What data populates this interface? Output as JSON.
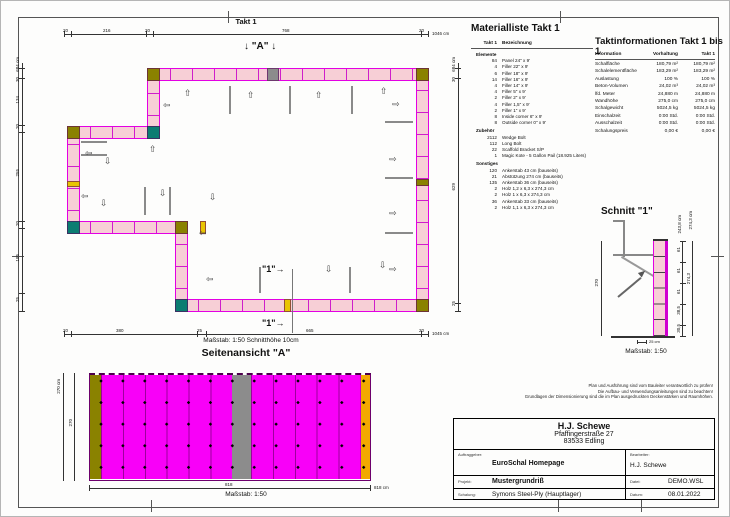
{
  "sheet": {
    "plan_title": "Takt 1",
    "plan_scale_note": "Maßstab: 1:50   Schnitthöhe 10cm",
    "view_arrow_label": "\"A\"",
    "section_marker_label": "\"1\""
  },
  "icons": {
    "arrow_up": "⇧",
    "arrow_down": "⇩",
    "arrow_left": "⇦",
    "arrow_right": "⇨",
    "down_arrow": "↓",
    "right_arrow": "→"
  },
  "plan_dims": {
    "top": [
      "20",
      "216",
      "20",
      "768",
      "20"
    ],
    "top_total": "1046 cm",
    "bottom": [
      "20",
      "380",
      "25",
      "665",
      "20"
    ],
    "bottom_total": "1045 cm",
    "left": [
      "30",
      "134",
      "20",
      "255",
      "20",
      "185",
      "25"
    ],
    "left_total": "684 cm",
    "right": [
      "30",
      "629",
      "25"
    ],
    "right_total": "684 cm"
  },
  "side_view": {
    "title": "Seitenansicht \"A\"",
    "height_total": "270 cm",
    "height_chain": "270",
    "width_mid": "818",
    "width_total": "818 cm",
    "scale": "Maßstab: 1:50"
  },
  "section_view": {
    "title": "Schnitt \"1\"",
    "scale": "Maßstab: 1:50",
    "scale_bar": "25 cm",
    "dim_height_left": "270",
    "dim_segments": [
      "61",
      "61",
      "61",
      "38,5",
      "30,5"
    ],
    "dim_total": "274,3",
    "dim_top_inner": "243,8 cm",
    "dim_top_outer": "274,3 cm"
  },
  "material_list": {
    "title": "Materialliste  Takt 1",
    "col_qty": "Takt 1",
    "col_name": "Bezeichnung",
    "rows": [
      {
        "qty": "",
        "name": "Elemente",
        "bold": true
      },
      {
        "qty": "84",
        "name": "Panel 24\" x 9'"
      },
      {
        "qty": "4",
        "name": "Filler 22\" x 9'"
      },
      {
        "qty": "6",
        "name": "Filler 18\" x 9'"
      },
      {
        "qty": "14",
        "name": "Filler 16\" x 9'"
      },
      {
        "qty": "4",
        "name": "Filler 14\" x 9'"
      },
      {
        "qty": "4",
        "name": "Filler 5\" x 9'"
      },
      {
        "qty": "2",
        "name": "Filler 2\" x 9'"
      },
      {
        "qty": "4",
        "name": "Filler 1,5\" x 9'"
      },
      {
        "qty": "2",
        "name": "Filler 1\" x 9'"
      },
      {
        "qty": "8",
        "name": "Inside corner 6\" x 9'"
      },
      {
        "qty": "8",
        "name": "Outside corner 0\" x 9'"
      },
      {
        "qty": "",
        "name": "Zubehör",
        "bold": true
      },
      {
        "qty": "2112",
        "name": "Wedge Bolt"
      },
      {
        "qty": "112",
        "name": "Long Bolt"
      },
      {
        "qty": "22",
        "name": "Scaffold Bracket S/P"
      },
      {
        "qty": "1",
        "name": "Magic Kote - 5 Gallon Pail (18.925 Liters)"
      },
      {
        "qty": "",
        "name": "Sonstiges",
        "bold": true
      },
      {
        "qty": "120",
        "name": "Ankerstab 43 cm (bauseits)"
      },
      {
        "qty": "21",
        "name": "Abstützung 274 cm (bauseits)"
      },
      {
        "qty": "135",
        "name": "Ankerstab 36 cm (bauseits)"
      },
      {
        "qty": "2",
        "name": "Holz 1,2 x 6,3 x 274,3 cm"
      },
      {
        "qty": "2",
        "name": "Holz 1 x 6,3 x 274,3 cm"
      },
      {
        "qty": "36",
        "name": "Ankerstab 33 cm (bauseits)"
      },
      {
        "qty": "2",
        "name": "Holz 1,1 x 6,3 x 274,3 cm"
      }
    ]
  },
  "takt_info": {
    "title": "Taktinformationen  Takt 1 bis 1",
    "col_info": "Information",
    "col_vorhaltung": "Vorhaltung",
    "col_takt": "Takt 1",
    "rows": [
      {
        "label": "Schalfläche",
        "vorhaltung": "180,79 m²",
        "takt": "180,79 m²"
      },
      {
        "label": "Schalelementfläche",
        "vorhaltung": "183,29 m²",
        "takt": "183,29 m²"
      },
      {
        "label": "Auslastung",
        "vorhaltung": "100 %",
        "takt": "100 %"
      },
      {
        "label": "Beton-Volumen",
        "vorhaltung": "24,02 m³",
        "takt": "24,02 m³"
      },
      {
        "label": "lfd. Meter",
        "vorhaltung": "24,880 m",
        "takt": "24,880 m"
      },
      {
        "label": "Wandhöhe",
        "vorhaltung": "275,0 cm",
        "takt": "275,0 cm"
      },
      {
        "label": "Schalgewicht",
        "vorhaltung": "5024,5 kg",
        "takt": "5024,5 kg"
      },
      {
        "label": "Einschalzeit",
        "vorhaltung": "0:00 Std.",
        "takt": "0:00 Std."
      },
      {
        "label": "Ausschalzeit",
        "vorhaltung": "0:00 Std.",
        "takt": "0:00 Std."
      },
      {
        "label": "Schalungspreis",
        "vorhaltung": "0,00 €",
        "takt": "0,00 €"
      }
    ]
  },
  "disclaimer": {
    "line1": "Plan und Ausführung sind vom Bauleiter verantwortlich zu prüfen!",
    "line2": "Die Aufbau- und Verwendungsanleitungen sind zu beachten!",
    "line3": "Grundlagen der Dimensionierung sind die im Plan ausgedruckten Deckenstärken und Raumhöhen."
  },
  "title_block": {
    "company": "H.J. Schewe",
    "street": "Pfaffingerstraße 27",
    "city": "83533 Edling",
    "label_auftraggeber": "Auftraggeber:",
    "auftraggeber": "EuroSchal Homepage",
    "label_bearbeiter": "Bearbeiter:",
    "bearbeiter": "H.J. Schewe",
    "label_projekt": "Projekt:",
    "projekt": "Mustergrundriß",
    "label_datei": "Datei:",
    "datei": "DEMO.WSL",
    "label_schalung": "Schalung:",
    "schalung": "Symons Steel-Ply (Hauptlager)",
    "label_datum": "Datum:",
    "datum": "08.01.2022"
  },
  "colors": {
    "panel_fill": "#f7cfd6",
    "panel_edge": "#e300e3",
    "elevation_magenta": "#f800f8",
    "gray_panel": "#8c8c8c",
    "olive_corner": "#8a8200",
    "teal_corner": "#0b7d72",
    "yellow_filler": "#e9c502",
    "orange_strip": "#f2a900"
  }
}
